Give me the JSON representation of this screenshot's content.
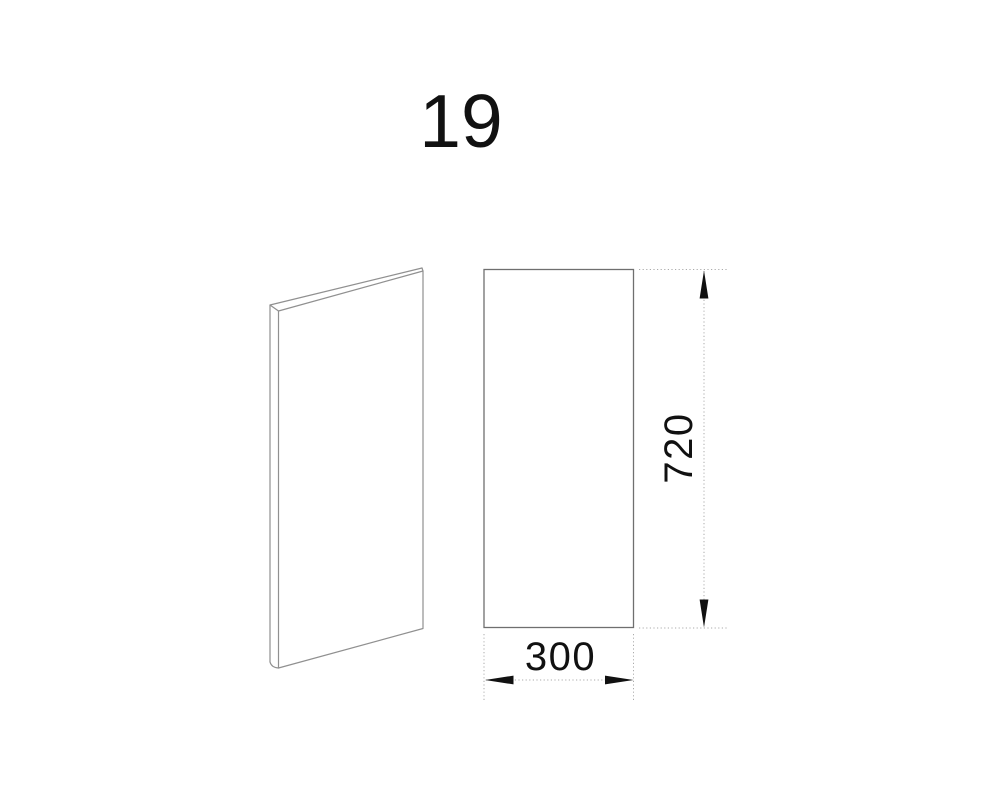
{
  "drawing": {
    "part_number": "19",
    "type": "panel-technical-drawing",
    "views": {
      "perspective_view": "thin rectangular panel shown in 3d perspective",
      "front_view": "panel front elevation rectangle"
    },
    "dimensions": {
      "width": {
        "label": "300",
        "orientation": "horizontal"
      },
      "height": {
        "label": "720",
        "orientation": "vertical"
      }
    }
  },
  "colors": {
    "background": "#ffffff",
    "object_line": "#909090",
    "front_view_line": "#6f6f6f",
    "dimension_line": "#ababab",
    "annotation": "#111111"
  }
}
